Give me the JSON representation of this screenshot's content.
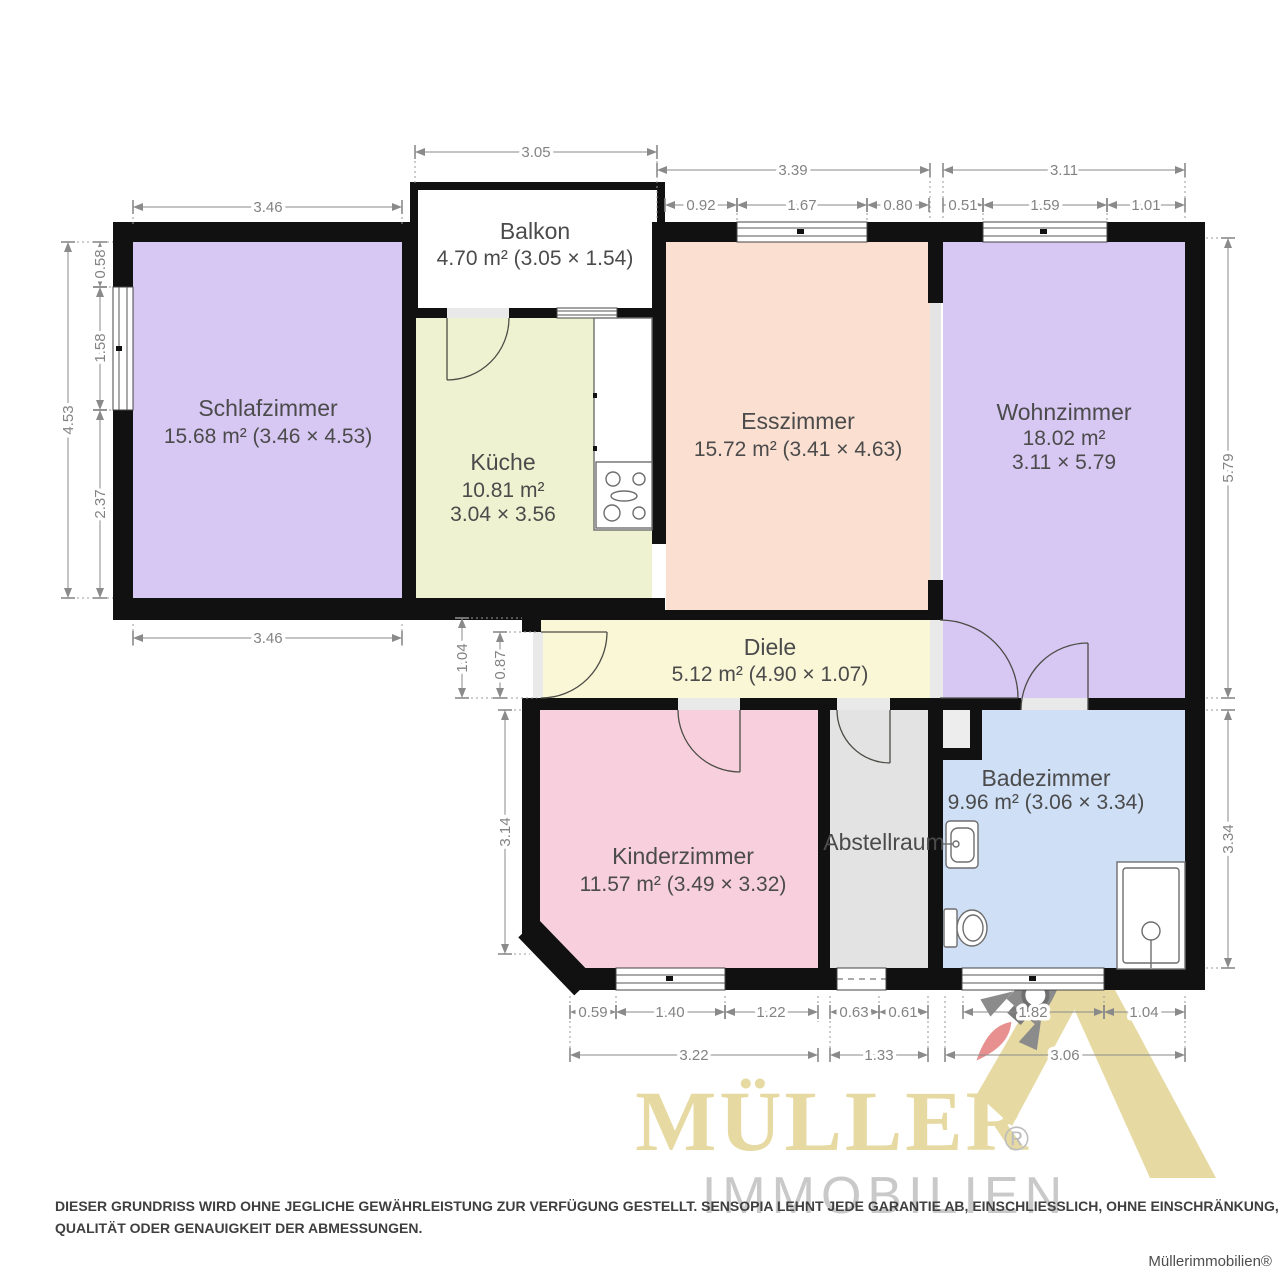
{
  "fp": {
    "rooms": {
      "schlafzimmer": {
        "name": "Schlafzimmer",
        "line2": "15.68 m² (3.46 × 4.53)"
      },
      "balkon": {
        "name": "Balkon",
        "line2": "4.70 m² (3.05 × 1.54)"
      },
      "kueche": {
        "name": "Küche",
        "line2": "10.81 m²",
        "line3": "3.04 × 3.56"
      },
      "esszimmer": {
        "name": "Esszimmer",
        "line2": "15.72 m² (3.41 × 4.63)"
      },
      "wohnzimmer": {
        "name": "Wohnzimmer",
        "line2": "18.02 m²",
        "line3": "3.11 × 5.79"
      },
      "diele": {
        "name": "Diele",
        "line2": "5.12 m² (4.90 × 1.07)"
      },
      "kinderzimmer": {
        "name": "Kinderzimmer",
        "line2": "11.57 m² (3.49 × 3.32)"
      },
      "abstellraum": {
        "name": "Abstellraum"
      },
      "badezimmer": {
        "name": "Badezimmer",
        "line2": "9.96 m² (3.06 × 3.34)"
      }
    },
    "colors": {
      "schlafzimmer": "#d7c7f3",
      "balkon": "#ffffff",
      "kueche": "#eff2d0",
      "esszimmer": "#fbdfd1",
      "wohnzimmer": "#d7c7f3",
      "diele": "#faf7d7",
      "kinderzimmer": "#f8d0dd",
      "abstellraum": "#e3e3e3",
      "badezimmer": "#cfdff6",
      "wall": "#111111",
      "dimension": "#838383",
      "label": "#4b4b4b",
      "logo_tan": "#e6d9a2",
      "logo_gray": "#c9c9c9",
      "rocket_gray": "#8b8b8b",
      "flame_red": "#e88f8f"
    },
    "dims": {
      "balkon_width": "3.05",
      "schlafzimmer_top": "3.46",
      "schlafzimmer_bottom": "3.46",
      "esszimmer_total": "3.39",
      "esszimmer_seg1": "0.92",
      "esszimmer_seg2": "1.67",
      "esszimmer_seg3": "0.80",
      "wohnzimmer_total": "3.11",
      "wohnzimmer_seg1": "0.51",
      "wohnzimmer_seg2": "1.59",
      "wohnzimmer_seg3": "1.01",
      "left_total": "4.53",
      "left_seg1": "0.58",
      "left_seg2": "1.58",
      "left_seg3": "2.37",
      "diele_left": "1.04",
      "entrance_door": "0.87",
      "kinderzimmer_left": "3.14",
      "wohnzimmer_right": "5.79",
      "badezimmer_right": "3.34",
      "kinder_seg1": "0.59",
      "kinder_seg2": "1.40",
      "kinder_seg3": "1.22",
      "kinder_total": "3.22",
      "abstell_seg1": "0.63",
      "abstell_seg2": "0.61",
      "abstell_total": "1.33",
      "bad_seg1": "1.82",
      "bad_seg2": "1.04",
      "bad_total": "3.06"
    }
  },
  "branding": {
    "logo_title": "MÜLLER",
    "logo_subtitle": "IMMOBILIEN",
    "registered": "®",
    "watermark": "Müllerimmobilien®"
  },
  "disclaimer": {
    "line1": "DIESER GRUNDRISS WIRD OHNE JEGLICHE GEWÄHRLEISTUNG ZUR VERFÜGUNG GESTELLT. SENSOPIA LEHNT JEDE GARANTIE AB, EINSCHLIESSLICH, OHNE EINSCHRÄNKUNG, ZUFRIEDENSTELLENDER",
    "line2": "QUALITÄT ODER GENAUIGKEIT DER ABMESSUNGEN."
  }
}
